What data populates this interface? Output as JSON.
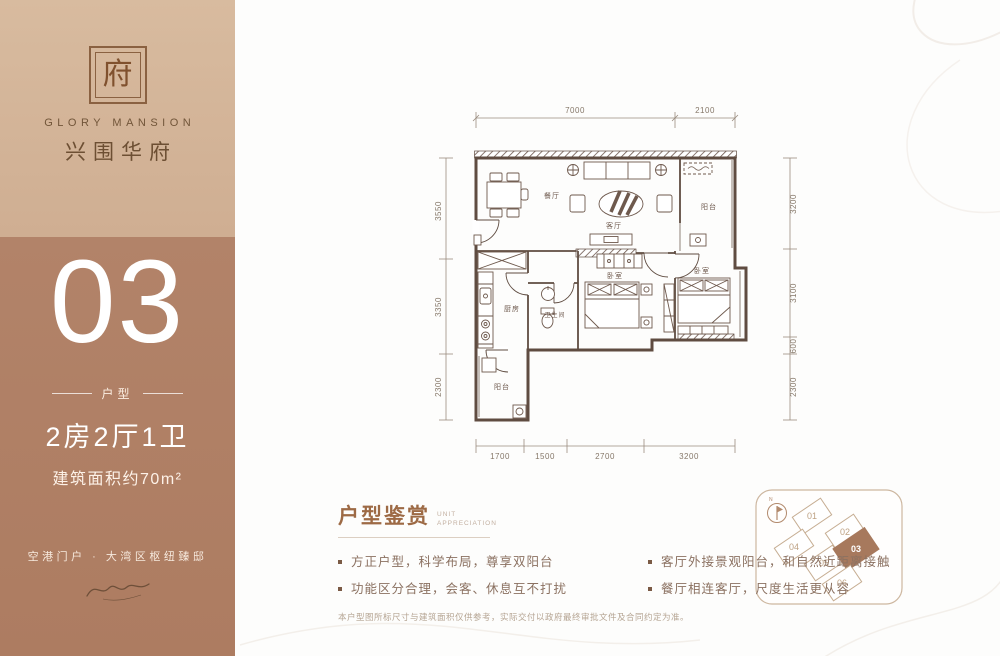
{
  "brand": {
    "seal_char": "府",
    "name_en": "GLORY MANSION",
    "name_cn": "兴围华府"
  },
  "unit": {
    "number": "03",
    "type_label": "户型",
    "layout": "2房2厅1卫",
    "area": "建筑面积约70m²",
    "tagline": "空港门户 · 大湾区枢纽臻邸"
  },
  "floorplan": {
    "rooms": {
      "dining": "餐厅",
      "living": "客厅",
      "balcony_top": "阳台",
      "bedroom_main": "卧室",
      "bedroom_second": "卧室",
      "kitchen": "厨房",
      "bathroom": "卫生间",
      "balcony_bottom": "阳台"
    },
    "dims_top": [
      "7000",
      "2100"
    ],
    "dims_left": [
      "3550",
      "3350",
      "2300"
    ],
    "dims_right": [
      "3200",
      "3100",
      "600",
      "2300"
    ],
    "dims_bottom": [
      "1700",
      "1500",
      "2700",
      "3200"
    ]
  },
  "appreciation": {
    "title": "户型鉴赏",
    "subtitle_top": "UNIT",
    "subtitle_bottom": "APPRECIATION",
    "bullets_left": [
      "方正户型，科学布局，尊享双阳台",
      "功能区分合理，会客、休息互不打扰"
    ],
    "bullets_right": [
      "客厅外接景观阳台，和自然近距离接触",
      "餐厅相连客厅，尺度生活更从容"
    ],
    "disclaimer": "本户型图所标尺寸与建筑面积仅供参考，实际交付以政府最终审批文件及合同约定为准。"
  },
  "keyplan": {
    "north": "N",
    "units": [
      "01",
      "02",
      "04",
      "05",
      "03",
      "06"
    ],
    "highlight": "03"
  },
  "colors": {
    "sidebar_top": "#d3b499",
    "sidebar_bottom": "#b08166",
    "accent_title": "#9d6a45",
    "plan_line": "#5f4c41",
    "keyplan_highlight": "#a7795d"
  }
}
